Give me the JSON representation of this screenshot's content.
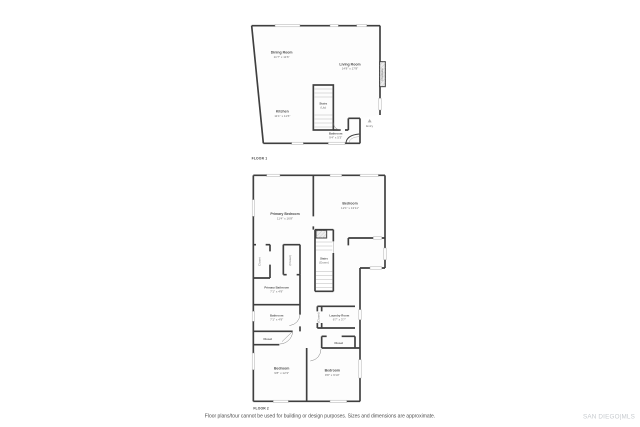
{
  "colors": {
    "wall": "#3f3f3f",
    "room_label": "#4f4f4f",
    "dimension_label": "#6e6e6e",
    "stair_tread": "#b8b8b8",
    "watermark": "#c7cbcf"
  },
  "floor1": {
    "title": "FLOOR 1",
    "rooms": {
      "dining": {
        "name": "Dining Room",
        "dims": "11'7\" x 11'6\""
      },
      "living": {
        "name": "Living Room",
        "dims": "14'8\" x 17'8\""
      },
      "kitchen": {
        "name": "Kitchen",
        "dims": "11'1\" x 11'6\""
      },
      "stairs": {
        "name": "Stairs",
        "dims": "(Up)"
      },
      "bathroom": {
        "name": "Bathroom",
        "dims": "9'4\" x 5'3\""
      },
      "entry": {
        "name": "Entry"
      },
      "fireplace": {
        "name": "Fireplace"
      }
    }
  },
  "floor2": {
    "title": "FLOOR 2",
    "rooms": {
      "primary_bedroom": {
        "name": "Primary Bedroom",
        "dims": "11'4\" x 16'8\""
      },
      "bedroom_top_right": {
        "name": "Bedroom",
        "dims": "12'1\" x 13'11\""
      },
      "closet_left": {
        "name": "Closet"
      },
      "closet_mid": {
        "name": "(Closet)"
      },
      "stairs": {
        "name": "Stairs",
        "dims": "(Down)"
      },
      "primary_bathroom": {
        "name": "Primary Bathroom",
        "dims": "7'1\" x 4'9\""
      },
      "bathroom": {
        "name": "Bathroom",
        "dims": "7'1\" x 4'9\""
      },
      "closet_hall": {
        "name": "Closet"
      },
      "laundry": {
        "name": "Laundry Room",
        "dims": "6'7\" x 3'7\""
      },
      "closet_laundry": {
        "name": "(Closet)"
      },
      "closet_below_laundry": {
        "name": "Closet"
      },
      "bedroom_bottom_left": {
        "name": "Bedroom",
        "dims": "9'8\" x 12'3\""
      },
      "bedroom_bottom_right": {
        "name": "Bedroom",
        "dims": "9'8\" x 9'10\""
      }
    }
  },
  "footer": {
    "disclaimer": "Floor plans/tour cannot be used for building or design purposes. Sizes and dimensions are approximate.",
    "watermark": "SAN DIEGO|MLS"
  }
}
